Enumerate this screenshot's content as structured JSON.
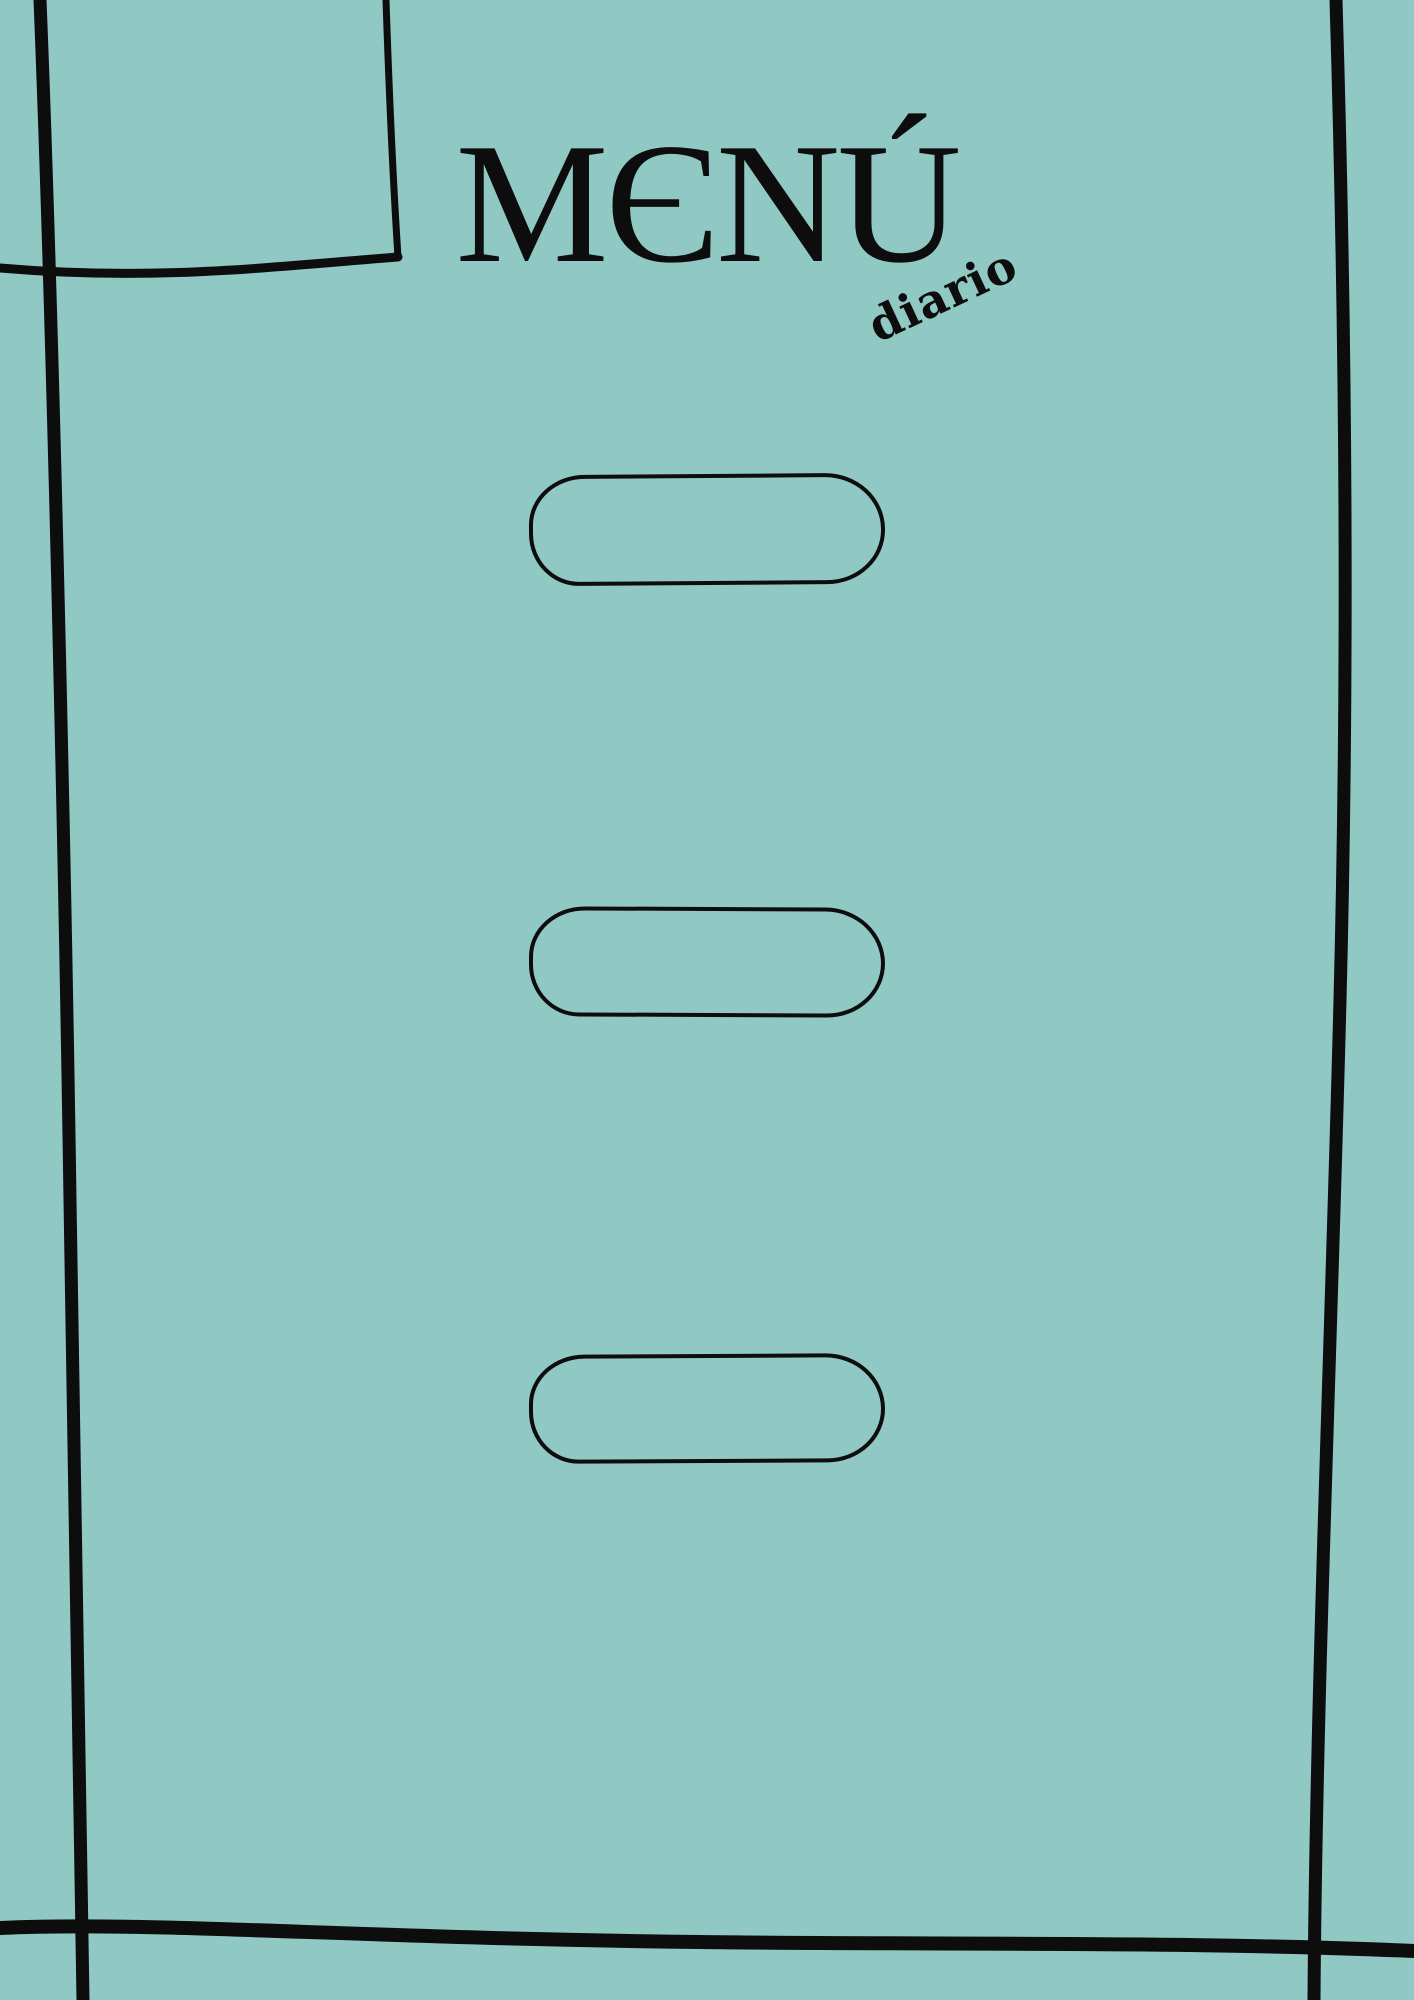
{
  "page": {
    "background_color": "#90C8C3",
    "ink_color": "#0D0D0D"
  },
  "header": {
    "title": "MENÚ",
    "subtitle": "diario"
  },
  "content": {
    "empty_item_slots": 3
  }
}
